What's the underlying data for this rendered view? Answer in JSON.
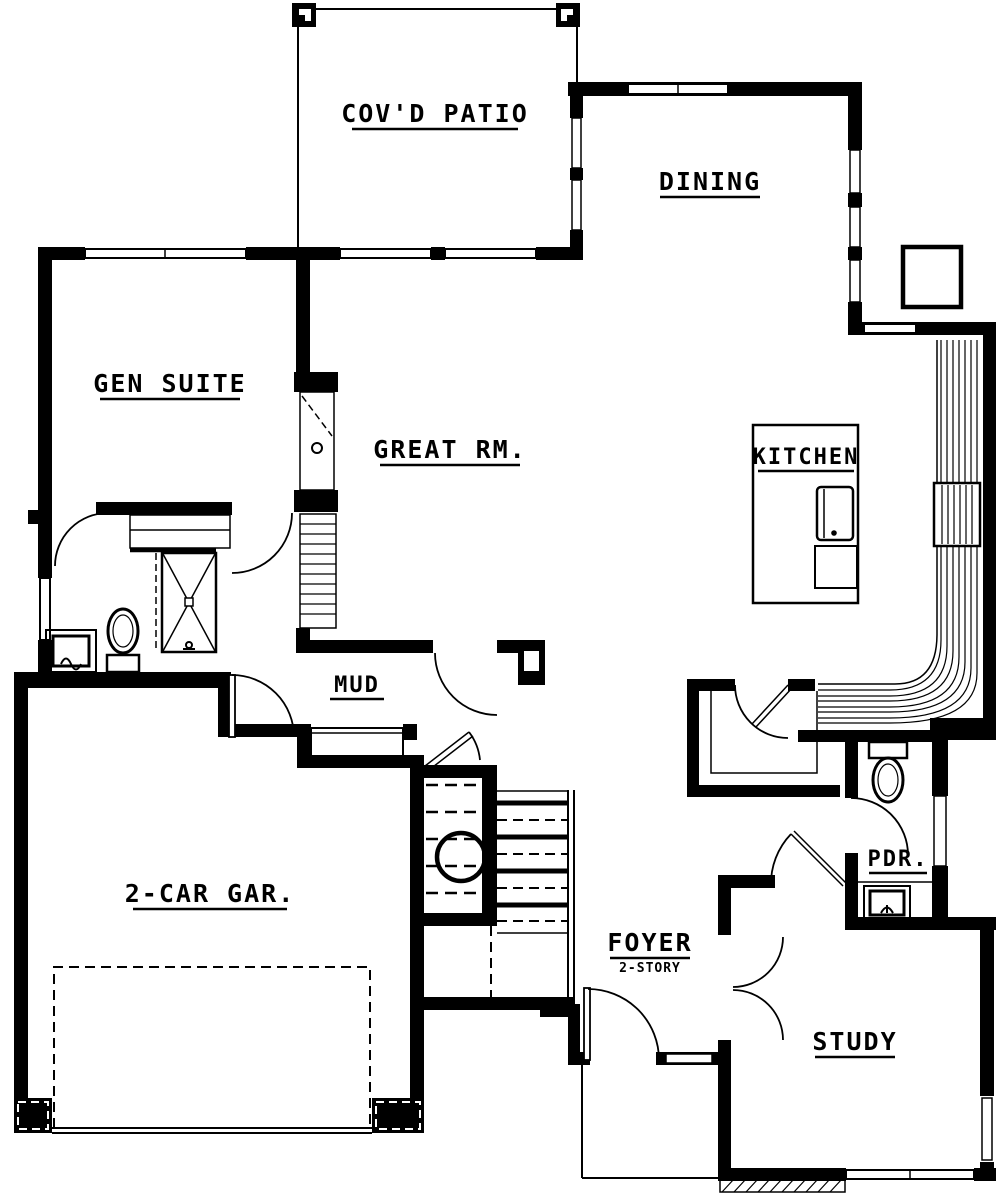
{
  "document": {
    "type": "architectural floor plan"
  },
  "colors": {
    "ink": "#000000",
    "paper": "#ffffff"
  },
  "rooms": [
    {
      "id": "covd-patio",
      "label": "COV'D PATIO"
    },
    {
      "id": "dining",
      "label": "DINING"
    },
    {
      "id": "gen-suite",
      "label": "GEN SUITE"
    },
    {
      "id": "great-room",
      "label": "GREAT RM."
    },
    {
      "id": "kitchen",
      "label": "KITCHEN"
    },
    {
      "id": "mud-room",
      "label": "MUD"
    },
    {
      "id": "garage",
      "label": "2-CAR GAR."
    },
    {
      "id": "foyer",
      "label": "FOYER",
      "sublabel": "2-STORY"
    },
    {
      "id": "powder-room",
      "label": "PDR."
    },
    {
      "id": "study",
      "label": "STUDY"
    }
  ],
  "fixtures": [
    "patio-post",
    "window",
    "door-swing",
    "toilet",
    "vanity-sink",
    "shower",
    "closet-shelf",
    "fireplace",
    "built-in-shelves",
    "kitchen-island",
    "kitchen-sink",
    "island-cabinet",
    "counter-hatch",
    "appliance",
    "pantry",
    "mud-bench",
    "stair-treads",
    "stair-landing",
    "newel-circle",
    "garage-door",
    "overhead-door-track",
    "front-door",
    "porch-edge",
    "deck-hatch",
    "french-doors",
    "powder-toilet",
    "powder-sink",
    "dining-cabinet"
  ]
}
